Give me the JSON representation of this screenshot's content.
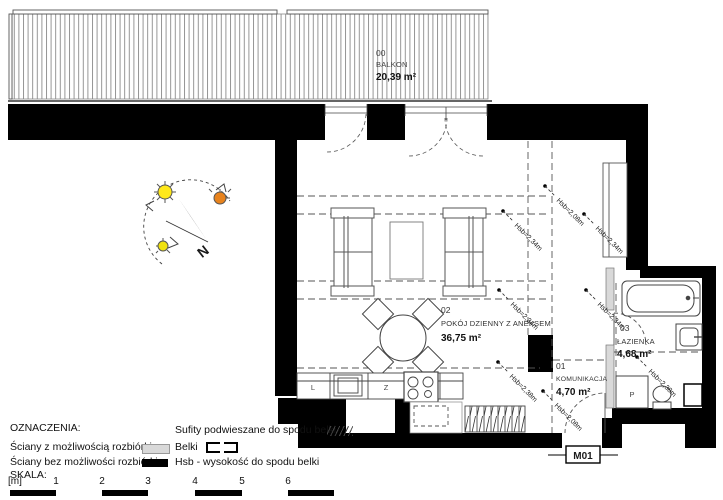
{
  "rooms": {
    "balcony": {
      "number": "00",
      "name": "BALKON",
      "area": "20,39 m²"
    },
    "living": {
      "number": "02",
      "name": "POKÓJ DZIENNY Z ANEKSEM",
      "area": "36,75 m²"
    },
    "hall": {
      "number": "01",
      "name": "KOMUNIKACJA",
      "area": "4,70 m²"
    },
    "bath": {
      "number": "03",
      "name": "ŁAZIENKA",
      "area": "4,68 m²"
    }
  },
  "hsb": [
    "Hsb=2,08m",
    "Hsb=2,34m",
    "Hsb=2,34m",
    "Hsb=2,34m",
    "Hsb=2,34m",
    "Hsb=2,38m",
    "Hsb=2,38m",
    "Hsb=2,08m"
  ],
  "fixtures": {
    "fridge": "L",
    "sink": "Z",
    "washer": "P"
  },
  "unit": {
    "label": "M01"
  },
  "compass": {
    "north": "N"
  },
  "legend": {
    "heading": "OZNACZENIA:",
    "wall_removable": "Ściany z możliwością rozbiórki",
    "wall_fixed": "Ściany bez możliwości rozbiórki",
    "ceiling": "Sufity podwieszane do spodu belki",
    "beams": "Belki",
    "hsb_note": "Hsb - wysokość do spodu belki",
    "scale_heading": "SKALA:",
    "scale_ticks": [
      "[m]",
      "1",
      "2",
      "3",
      "4",
      "5",
      "6"
    ]
  },
  "colors": {
    "wall": "#000000",
    "removable_wall": "#d9d9d9",
    "sun_yellow": "#ffe81a",
    "sun_orange": "#e8831d"
  }
}
